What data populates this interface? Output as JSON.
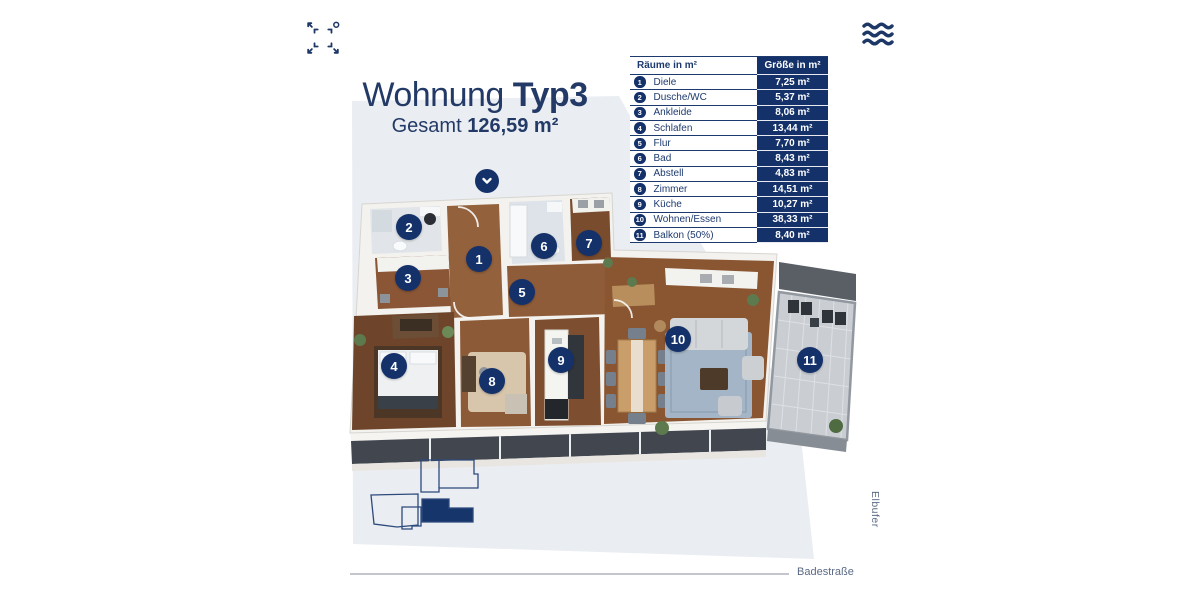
{
  "page": {
    "title_regular": "Wohnung",
    "title_bold": "Typ3",
    "subtitle_regular": "Gesamt",
    "subtitle_bold": "126,59 m²",
    "street_label": "Badestraße",
    "river_label": "Elbufer"
  },
  "icons": {
    "top_left": "compass-expand-icon",
    "top_right": "water-waves-icon",
    "scroll": "chevron-down-icon"
  },
  "table": {
    "header": {
      "rooms": "Räume in m²",
      "size": "Größe in m²"
    },
    "rows": [
      {
        "num": "1",
        "name": "Diele",
        "size": "7,25 m²"
      },
      {
        "num": "2",
        "name": "Dusche/WC",
        "size": "5,37 m²"
      },
      {
        "num": "3",
        "name": "Ankleide",
        "size": "8,06 m²"
      },
      {
        "num": "4",
        "name": "Schlafen",
        "size": "13,44 m²"
      },
      {
        "num": "5",
        "name": "Flur",
        "size": "7,70 m²"
      },
      {
        "num": "6",
        "name": "Bad",
        "size": "8,43 m²"
      },
      {
        "num": "7",
        "name": "Abstell",
        "size": "4,83 m²"
      },
      {
        "num": "8",
        "name": "Zimmer",
        "size": "14,51 m²"
      },
      {
        "num": "9",
        "name": "Küche",
        "size": "10,27 m²"
      },
      {
        "num": "10",
        "name": "Wohnen/Essen",
        "size": "38,33 m²"
      },
      {
        "num": "11",
        "name": "Balkon (50%)",
        "size": "8,40 m²"
      }
    ]
  },
  "floorplan": {
    "badges": [
      {
        "num": "1",
        "x": 479,
        "y": 259
      },
      {
        "num": "2",
        "x": 409,
        "y": 227
      },
      {
        "num": "3",
        "x": 408,
        "y": 278
      },
      {
        "num": "4",
        "x": 394,
        "y": 366
      },
      {
        "num": "5",
        "x": 522,
        "y": 292
      },
      {
        "num": "6",
        "x": 544,
        "y": 246
      },
      {
        "num": "7",
        "x": 589,
        "y": 243
      },
      {
        "num": "8",
        "x": 492,
        "y": 381
      },
      {
        "num": "9",
        "x": 561,
        "y": 360
      },
      {
        "num": "10",
        "x": 678,
        "y": 339
      },
      {
        "num": "11",
        "x": 810,
        "y": 360
      }
    ]
  },
  "colors": {
    "navy": "#14316a",
    "title_navy": "#233a66",
    "bg_polygon": "#eaedf2",
    "label_gray": "#5a6a85"
  }
}
